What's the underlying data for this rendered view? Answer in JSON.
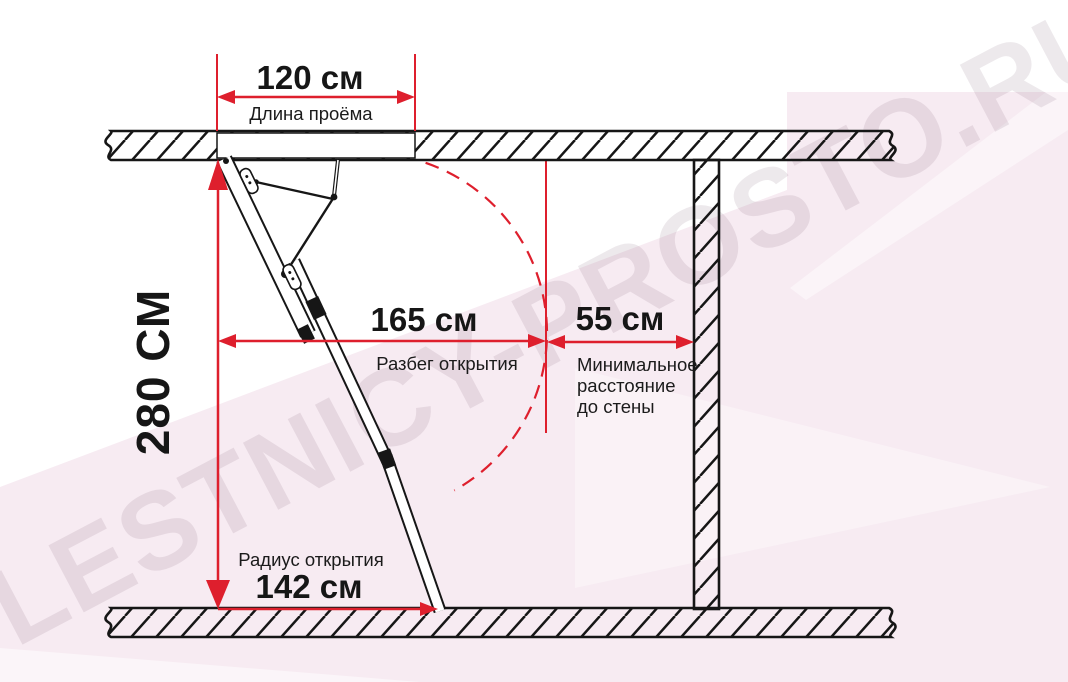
{
  "watermark": {
    "text": "LESTNICY-PROSTO.RU"
  },
  "colors": {
    "dimension_red": "#de1f2d",
    "line_black": "#161616",
    "background_pink": "#f7ebf2"
  },
  "dims": {
    "opening": {
      "value": "120 см",
      "label": "Длина проёма"
    },
    "height": {
      "value": "280 СМ"
    },
    "run": {
      "value": "165 см",
      "label": "Разбег открытия"
    },
    "wall": {
      "value": "55 см",
      "label_lines": [
        "Минимальное",
        "расстояние",
        "до стены"
      ]
    },
    "radius": {
      "value": "142 см",
      "label": "Радиус открытия"
    }
  }
}
